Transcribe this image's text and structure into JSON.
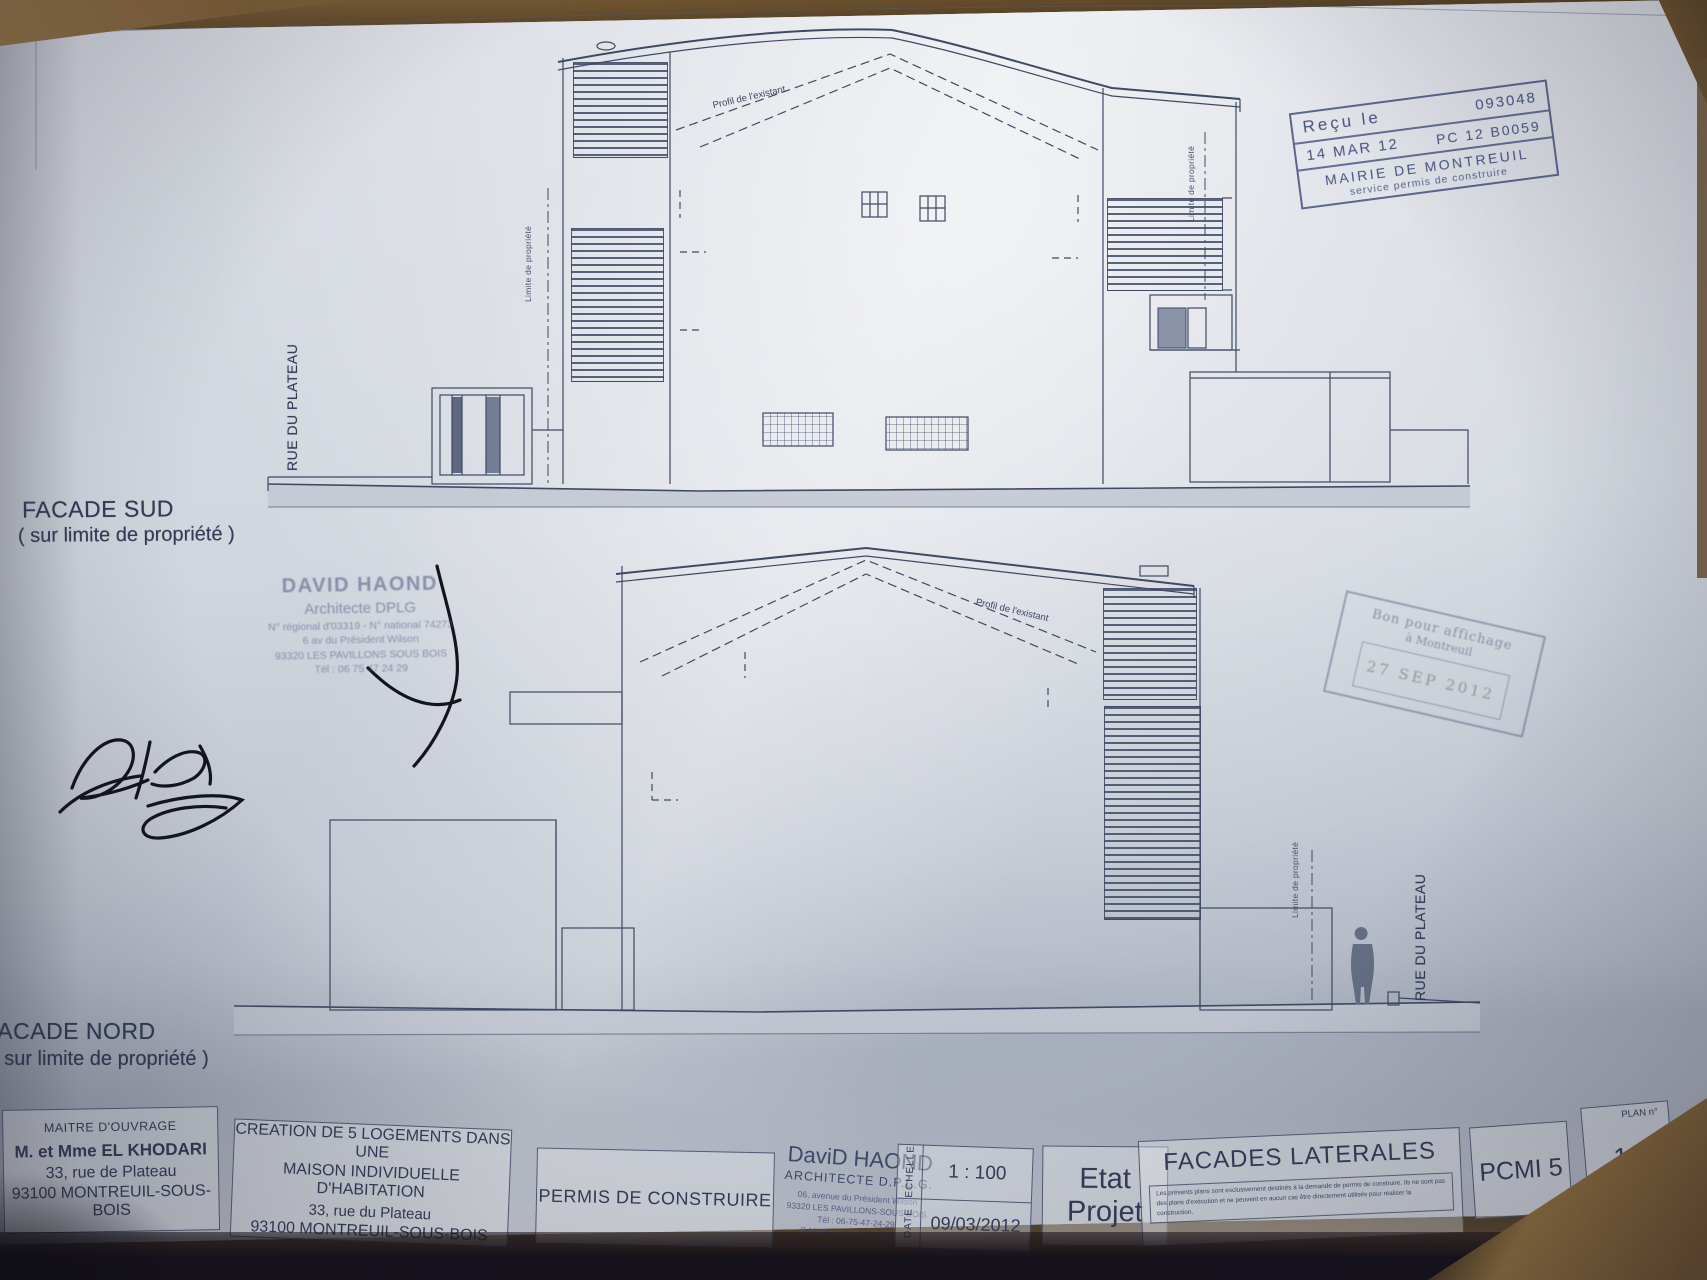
{
  "labels": {
    "facade_sud_title": "FACADE SUD",
    "facade_sud_sub": "( sur limite de propriété )",
    "facade_nord_title": "FACADE NORD",
    "facade_nord_sub": "( sur limite de propriété )",
    "rue_du_plateau": "RUE DU PLATEAU",
    "limite_de_propriete": "Limite de propriété",
    "profil_existant": "Profil de l'existant"
  },
  "stamps": {
    "mairie": {
      "recu_le": "Reçu le",
      "number": "093048",
      "date": "14 MAR 12",
      "ref": "PC 12 B0059",
      "org": "MAIRIE DE MONTREUIL",
      "service": "service permis de construire"
    },
    "architecte": {
      "name": "DAVID HAOND",
      "title": "Architecte DPLG",
      "registration": "N° régional d'03319 - N° national 74273",
      "address1": "6 av du Président Wilson",
      "address2": "93320 LES PAVILLONS SOUS BOIS",
      "tel": "Tél : 06 75 47 24 29"
    },
    "bon_pour": {
      "line1": "Bon pour affichage",
      "line2": "à Montreuil",
      "date": "27 SEP 2012"
    }
  },
  "title_block": {
    "maitre_douvrage": {
      "header": "MAITRE D'OUVRAGE",
      "name": "M. et Mme EL KHODARI",
      "address1": "33, rue de Plateau",
      "address2": "93100 MONTREUIL-SOUS-BOIS"
    },
    "projet": {
      "line1": "CREATION DE 5 LOGEMENTS DANS UNE",
      "line2": "MAISON INDIVIDUELLE D'HABITATION",
      "address1": "33, rue du Plateau",
      "address2": "93100 MONTREUIL-SOUS-BOIS"
    },
    "permis": "PERMIS DE CONSTRUIRE",
    "architecte": {
      "name": "DaviD HAOND",
      "title": "ARCHITECTE D.P.L.G.",
      "address1": "06, avenue du Président Wilson",
      "address2": "93320 LES PAVILLONS-SOUS-BOIS",
      "tel": "Tél : 06-75-47-24-29",
      "email": "E.MAIL : davidhaond@free.fr"
    },
    "echelle": {
      "label": "ECHELLE",
      "value": "1 : 100"
    },
    "date": {
      "label": "DATE",
      "value": "09/03/2012"
    },
    "etat": {
      "line1": "Etat",
      "line2": "Projet"
    },
    "drawing_title": "FACADES LATERALES",
    "disclaimer": "Les présents plans sont exclusivement destinés à la demande de permis de construire. Ils ne sont pas des plans d'exécution et ne peuvent en aucun cas être directement utilisés pour réaliser la construction.",
    "pcmi": "PCMI 5",
    "plan": {
      "label": "PLAN n°",
      "number": "16"
    }
  }
}
